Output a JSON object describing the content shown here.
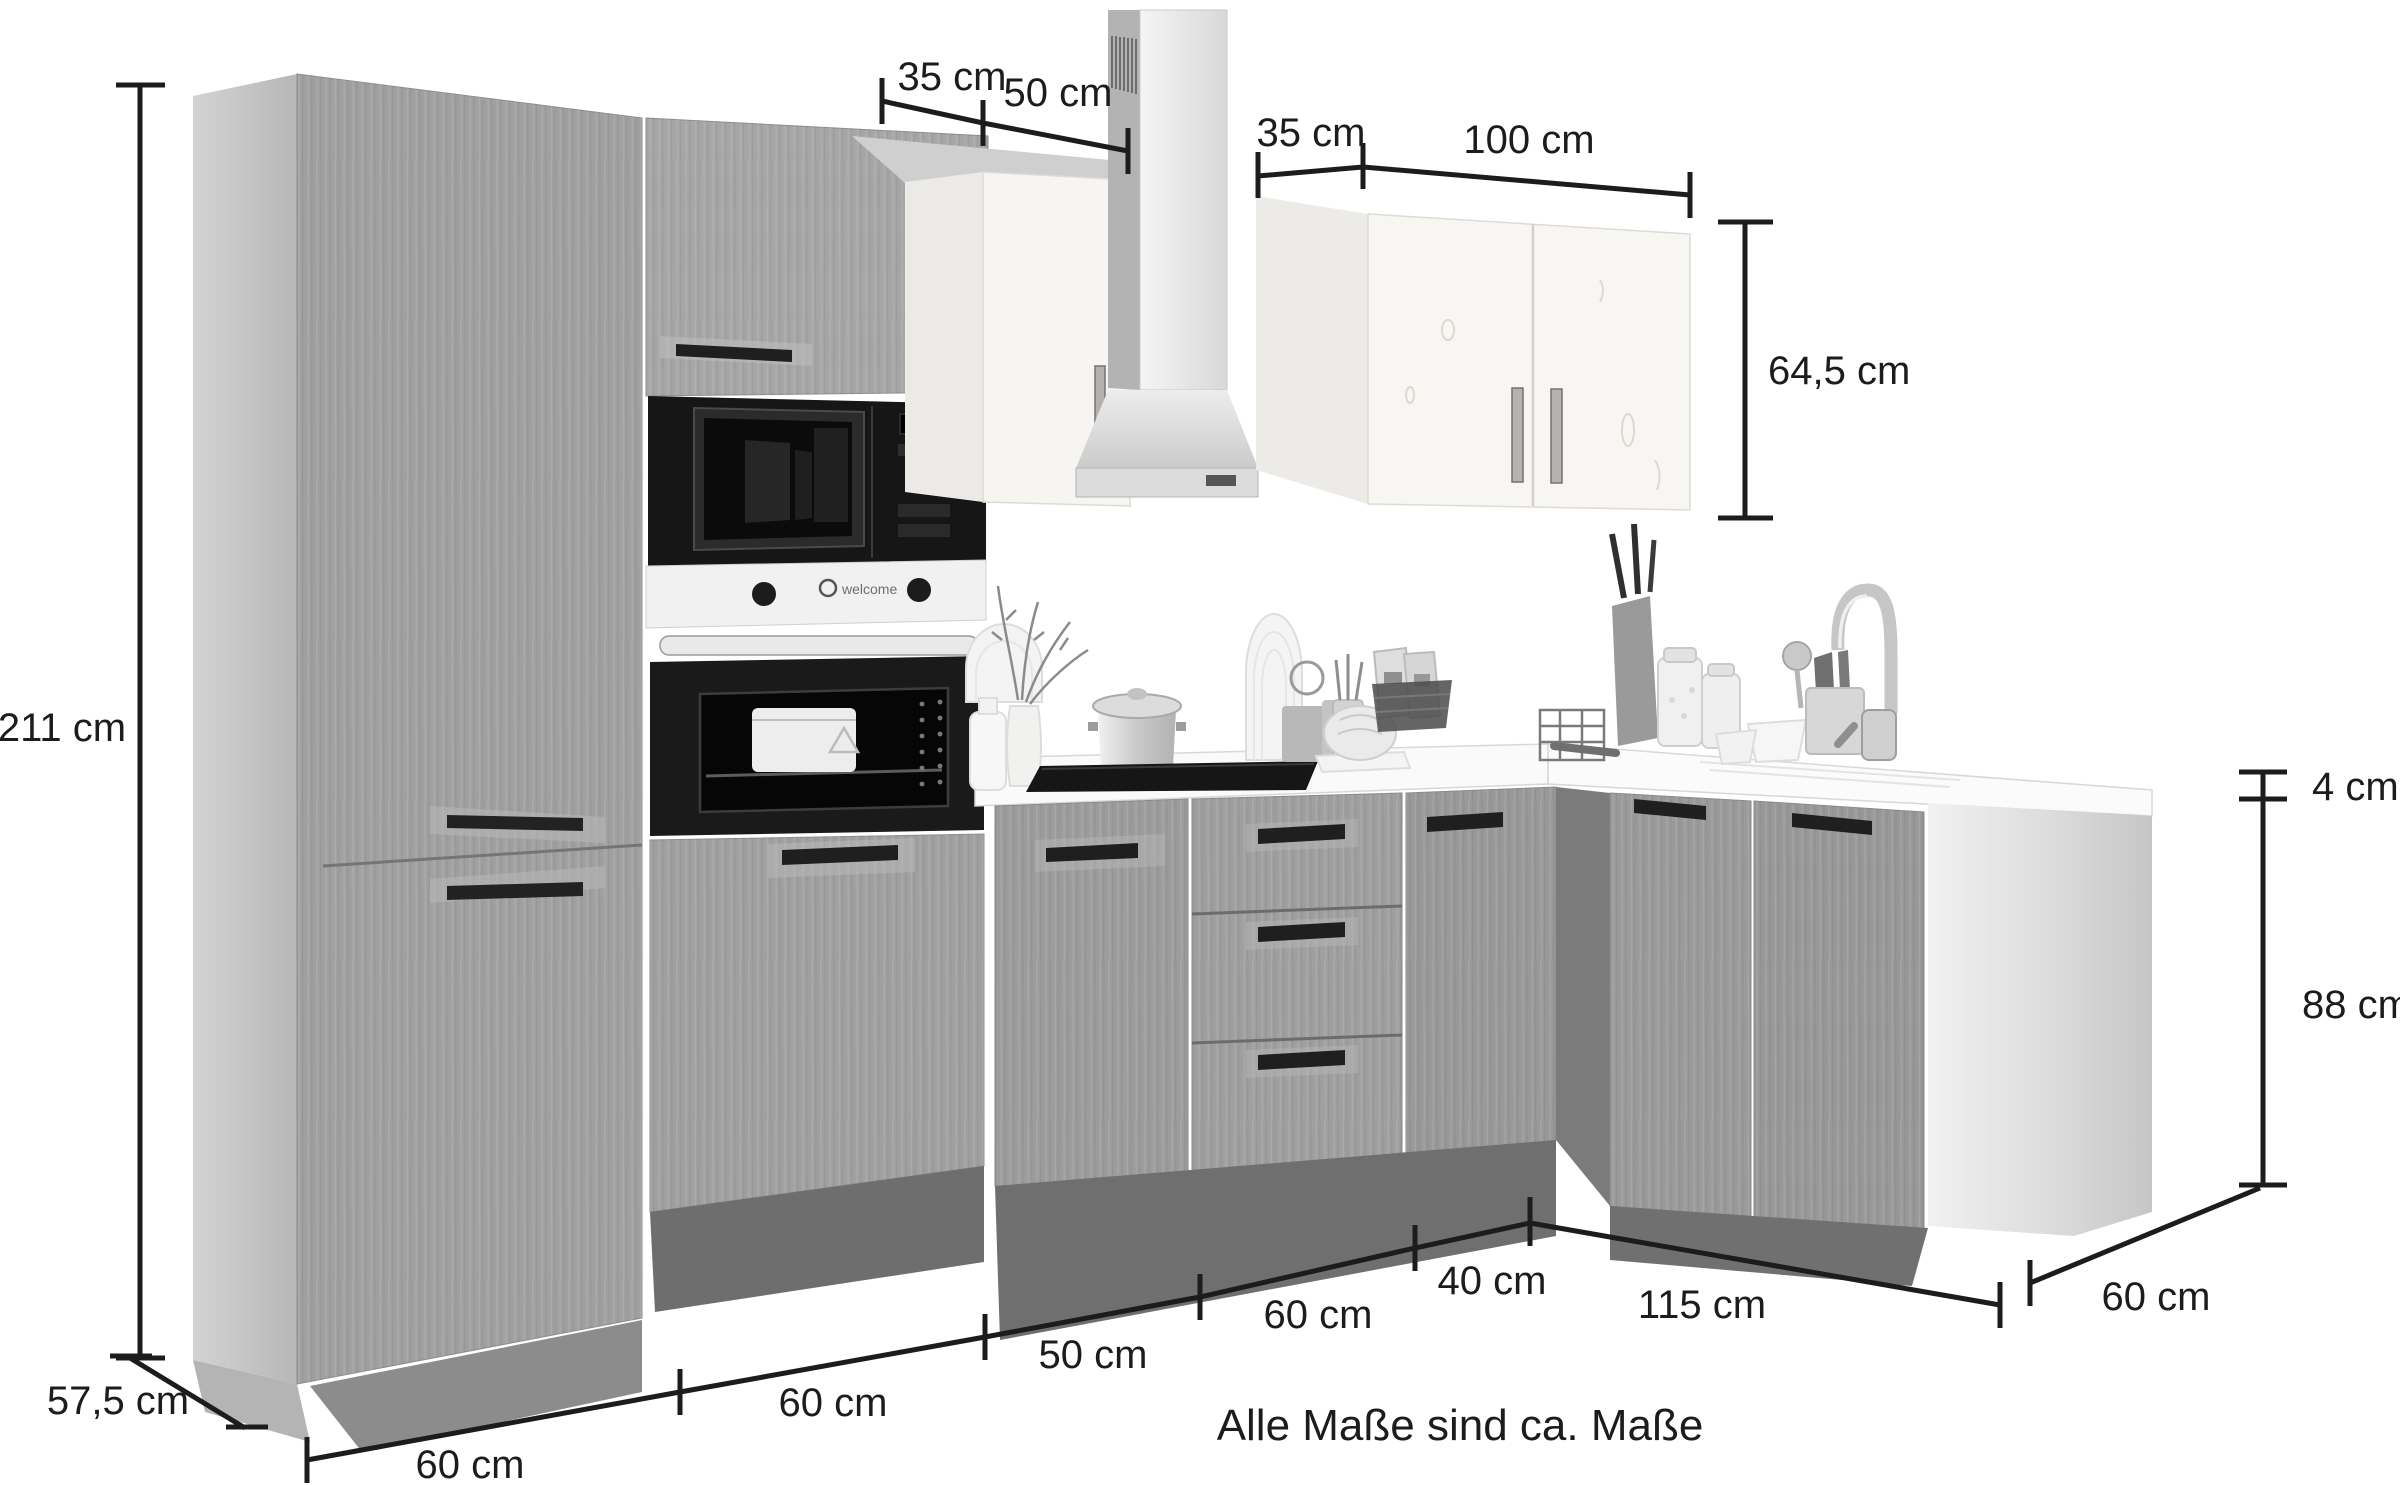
{
  "note": "Alle Maße sind ca. Maße",
  "unit": "cm",
  "dimensions": {
    "total_height": "211 cm",
    "left_side_depth": "57,5 cm",
    "hood_duct_depth": "35 cm",
    "hood_width": "50 cm",
    "wall_cabinet_depth": "35 cm",
    "wall_cabinet_width": "100 cm",
    "wall_cabinet_height": "64,5 cm",
    "worktop_thickness": "4 cm",
    "base_cabinet_height": "88 cm",
    "base_unit_1_width": "60 cm",
    "base_unit_2_width": "60 cm",
    "base_unit_3_width": "50 cm",
    "base_unit_4_width": "60 cm",
    "base_unit_5_width": "40 cm",
    "right_run_length": "115 cm",
    "right_run_depth": "60 cm"
  },
  "appliances": {
    "microwave_display": "1008",
    "oven_brand_label": "welcome"
  },
  "colors": {
    "annotation": "#1c1c1c",
    "cabinet_gray": "#9e9e9e",
    "plinth_gray": "#6f6f6f",
    "appliance_black": "#161616",
    "white_wood": "#f6f5f2",
    "background": "#ffffff"
  }
}
